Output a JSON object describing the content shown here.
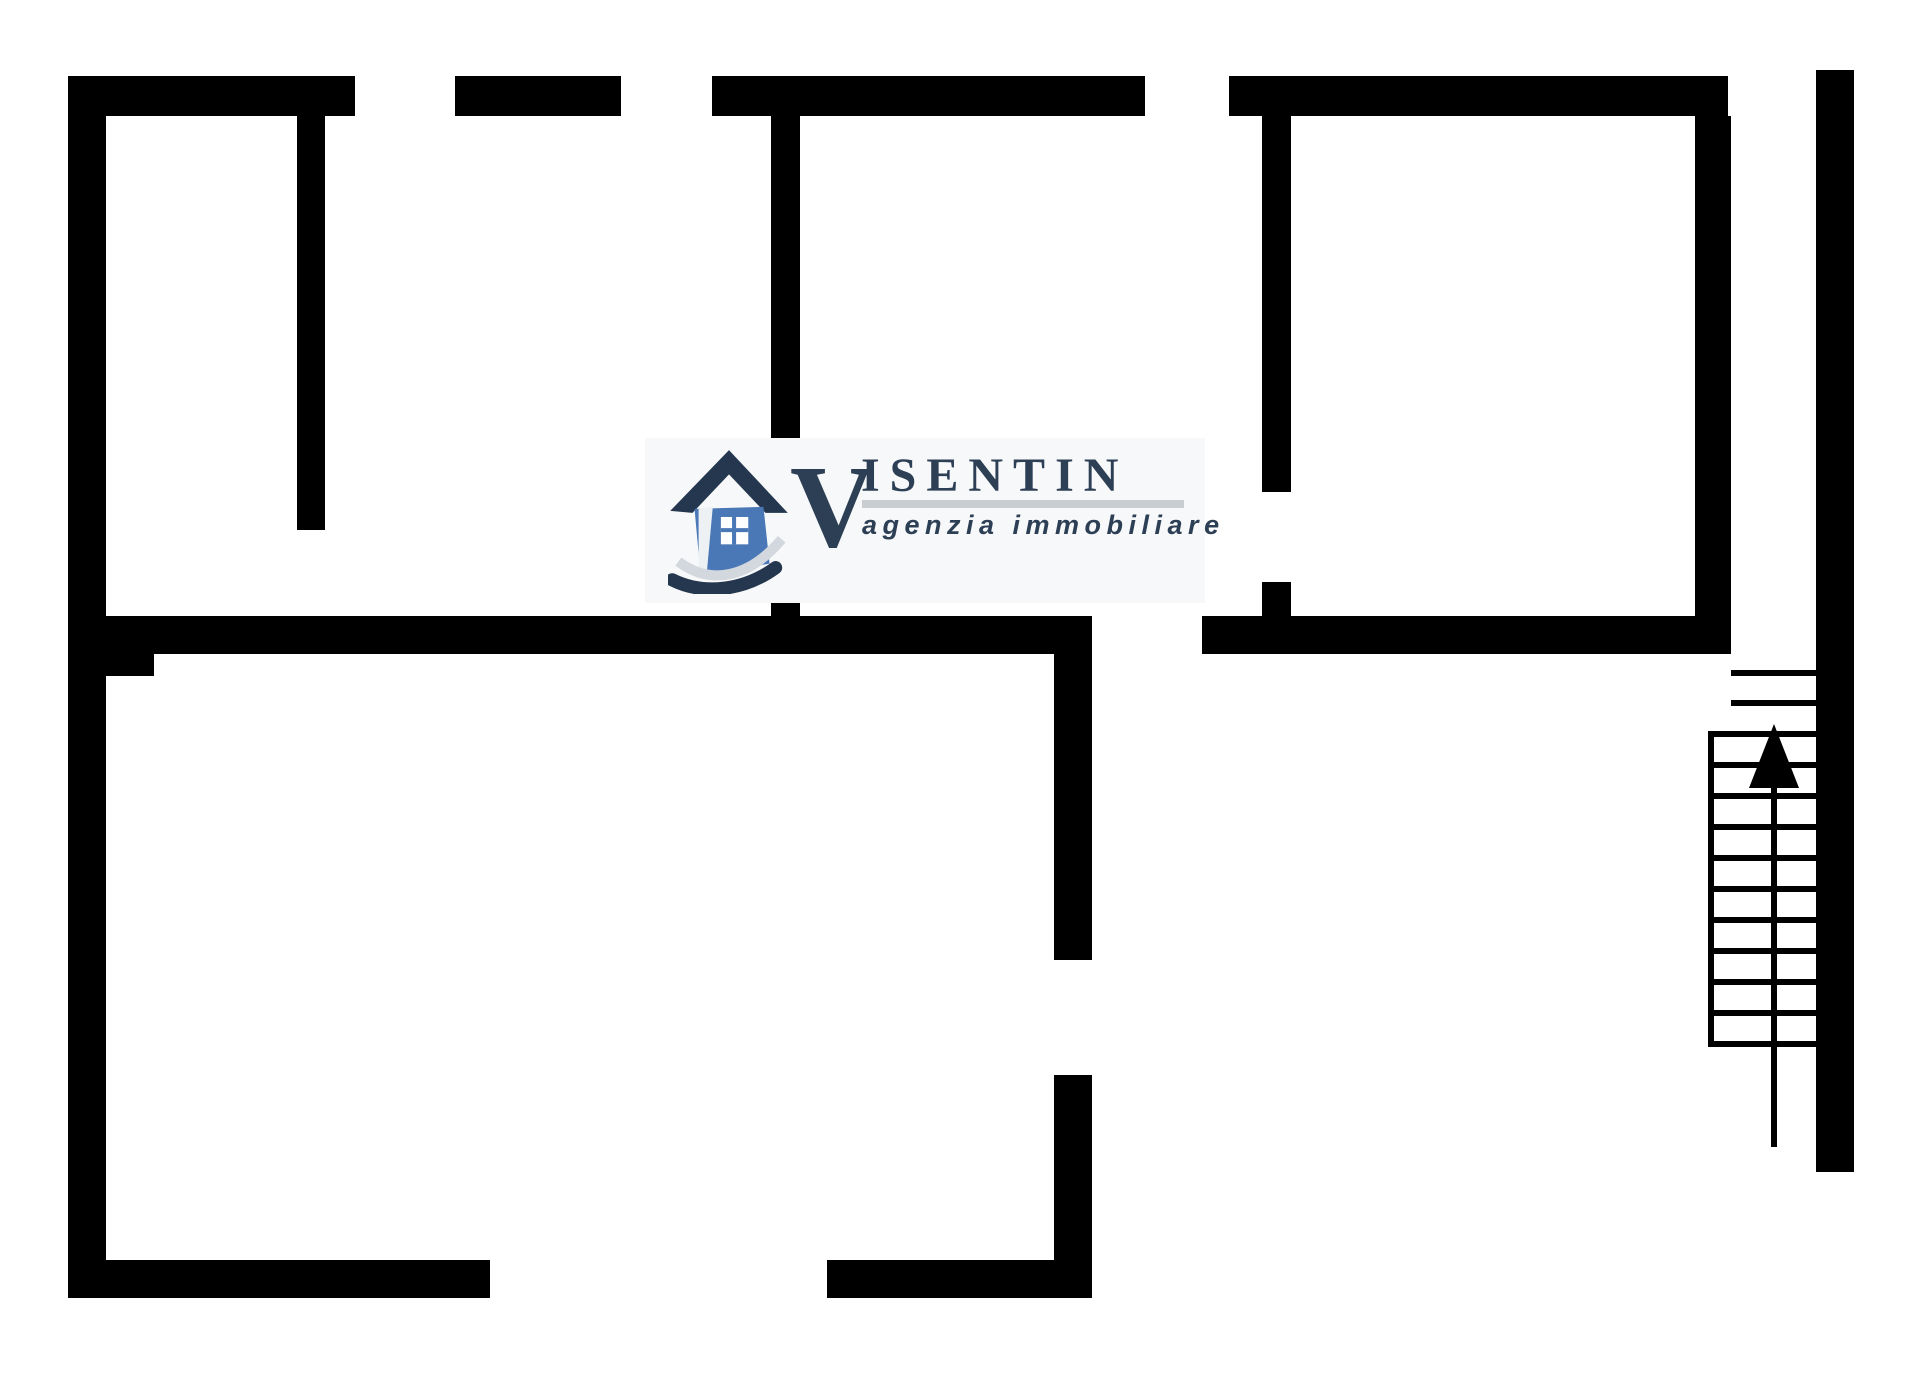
{
  "page": {
    "background": "#ffffff",
    "width": 1920,
    "height": 1383,
    "description": "black-and-white apartment floor plan with staircase and agency watermark"
  },
  "floorplan": {
    "wall_color": "#000000",
    "walls": [
      {
        "name": "top-wall-segment-1",
        "x": 68,
        "y": 76,
        "w": 287,
        "h": 40
      },
      {
        "name": "top-wall-segment-2",
        "x": 455,
        "y": 76,
        "w": 166,
        "h": 40
      },
      {
        "name": "top-wall-segment-3",
        "x": 712,
        "y": 76,
        "w": 433,
        "h": 40
      },
      {
        "name": "top-wall-segment-4",
        "x": 1229,
        "y": 76,
        "w": 499,
        "h": 40
      },
      {
        "name": "left-outer-wall",
        "x": 68,
        "y": 76,
        "w": 38,
        "h": 1222
      },
      {
        "name": "room-a-right-wall",
        "x": 297,
        "y": 116,
        "w": 28,
        "h": 414
      },
      {
        "name": "room-b-left-wall-upper",
        "x": 771,
        "y": 116,
        "w": 29,
        "h": 329
      },
      {
        "name": "room-b-left-wall-stub",
        "x": 771,
        "y": 598,
        "w": 29,
        "h": 56
      },
      {
        "name": "room-c-left-wall-upper",
        "x": 1262,
        "y": 116,
        "w": 29,
        "h": 376
      },
      {
        "name": "room-c-left-wall-stub",
        "x": 1262,
        "y": 582,
        "w": 29,
        "h": 72
      },
      {
        "name": "room-c-right-wall",
        "x": 1695,
        "y": 116,
        "w": 36,
        "h": 538
      },
      {
        "name": "middle-divider-wall-upper",
        "x": 1054,
        "y": 654,
        "w": 38,
        "h": 306
      },
      {
        "name": "middle-divider-wall-lower",
        "x": 1054,
        "y": 1075,
        "w": 38,
        "h": 223
      },
      {
        "name": "right-outer-wall",
        "x": 1816,
        "y": 70,
        "w": 38,
        "h": 1102
      },
      {
        "name": "mid-wall-left",
        "x": 68,
        "y": 616,
        "w": 1024,
        "h": 38
      },
      {
        "name": "mid-wall-left-notch",
        "x": 106,
        "y": 654,
        "w": 48,
        "h": 22
      },
      {
        "name": "mid-wall-right",
        "x": 1202,
        "y": 616,
        "w": 529,
        "h": 38
      },
      {
        "name": "bottom-wall-left",
        "x": 68,
        "y": 1260,
        "w": 422,
        "h": 38
      },
      {
        "name": "bottom-wall-middle",
        "x": 827,
        "y": 1260,
        "w": 265,
        "h": 38
      }
    ],
    "stairs": {
      "line_color": "#000000",
      "line_thickness": 6,
      "left_rail": {
        "x": 1708,
        "y": 731,
        "w": 6,
        "h": 316
      },
      "center_line": {
        "x": 1771,
        "y": 786,
        "w": 6,
        "h": 361
      },
      "treads": [
        {
          "y": 670,
          "x": 1731,
          "w": 85
        },
        {
          "y": 700,
          "x": 1731,
          "w": 85
        },
        {
          "y": 731,
          "x": 1714,
          "w": 102
        },
        {
          "y": 762,
          "x": 1714,
          "w": 102
        },
        {
          "y": 793,
          "x": 1714,
          "w": 102
        },
        {
          "y": 824,
          "x": 1714,
          "w": 102
        },
        {
          "y": 855,
          "x": 1714,
          "w": 102
        },
        {
          "y": 886,
          "x": 1714,
          "w": 102
        },
        {
          "y": 917,
          "x": 1714,
          "w": 102
        },
        {
          "y": 948,
          "x": 1714,
          "w": 102
        },
        {
          "y": 979,
          "x": 1714,
          "w": 102
        },
        {
          "y": 1010,
          "x": 1714,
          "w": 102
        },
        {
          "y": 1041,
          "x": 1708,
          "w": 108
        }
      ],
      "arrow": {
        "tip_x": 1774,
        "tip_y": 724,
        "half_width": 25,
        "head_height": 64,
        "direction": "up"
      }
    }
  },
  "logo": {
    "box": {
      "x": 645,
      "y": 438,
      "w": 560,
      "h": 165,
      "bg": "#f7f8f9"
    },
    "brand_initial": "V",
    "brand_rest": "ISENTIN",
    "tagline": "agenzia immobiliare",
    "text_color": "#2d3f55",
    "underline_color": "#c9cdd2",
    "house_icon_colors": {
      "roof": "#24374e",
      "body": "#4a77b5",
      "swoosh": "#d3d8de"
    },
    "layout": {
      "initial": {
        "x": 790,
        "y": 448,
        "size": 118
      },
      "rest": {
        "x": 861,
        "y": 452,
        "size": 48,
        "spacing": 10
      },
      "underline": {
        "x": 862,
        "y": 500,
        "w": 322,
        "h": 8
      },
      "tagline": {
        "x": 862,
        "y": 512,
        "size": 27,
        "spacing": 5.5
      },
      "house": {
        "x": 668,
        "y": 444,
        "w": 122,
        "h": 150
      }
    }
  }
}
